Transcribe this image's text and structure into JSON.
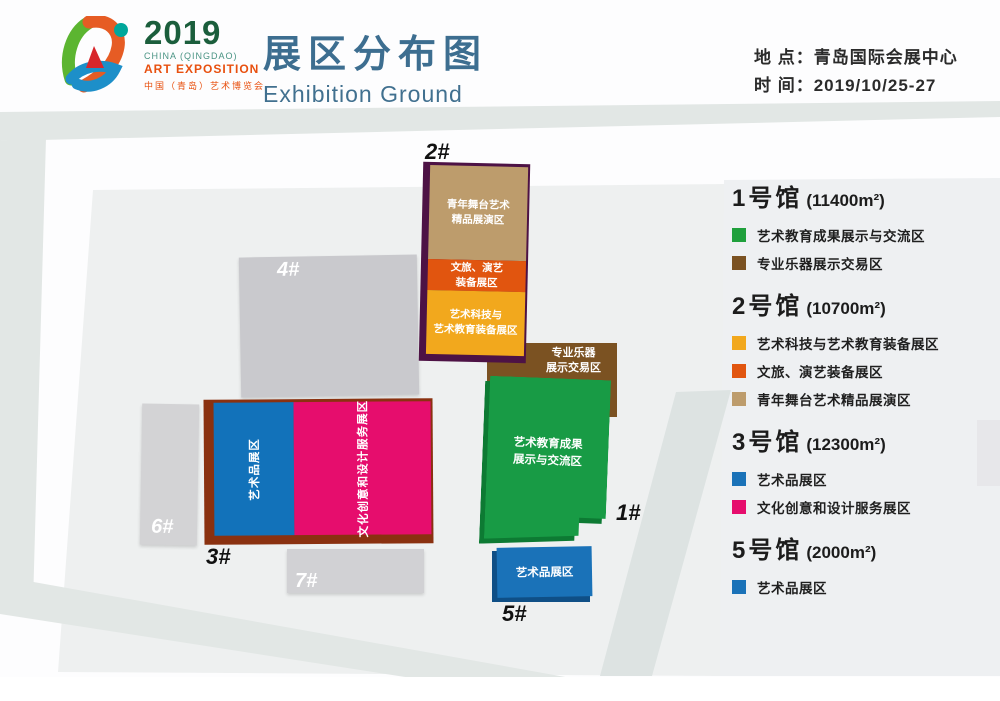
{
  "colors": {
    "tan": "#BD9C6C",
    "orange": "#E1550F",
    "yellow": "#F2A81D",
    "purple_edge": "#4D1245",
    "brown": "#7B5222",
    "green": "#189B45",
    "green_dark": "#0D7A33",
    "blue": "#1A72B8",
    "blue_dark": "#0F4F86",
    "pink": "#E60D6D",
    "maroon_edge": "#8A3110",
    "gray_building": "#C9C9CD",
    "title_blue": "#3D6E90"
  },
  "header": {
    "logo": {
      "year": "2019",
      "sub1": "CHINA (QINGDAO)",
      "sub2": "ART EXPOSITION",
      "sub3": "中国（青岛）艺术博览会"
    },
    "title_cn": "展区分布图",
    "title_en": "Exhibition Ground",
    "info_location": "地 点：青岛国际会展中心",
    "info_time": "时 间：2019/10/25-27"
  },
  "map": {
    "hall2": {
      "label": "2#",
      "sections": [
        {
          "text": "青年舞台艺术\n精品展演区",
          "color": "#BD9C6C"
        },
        {
          "text": "文旅、演艺\n装备展区",
          "color": "#E1550F"
        },
        {
          "text": "艺术科技与\n艺术教育装备展区",
          "color": "#F2A81D"
        }
      ]
    },
    "instruments_block": {
      "text": "专业乐器\n展示交易区",
      "color": "#7B5222"
    },
    "hall1": {
      "label": "1#",
      "text": "艺术教育成果\n展示与交流区",
      "color": "#189B45"
    },
    "hall3": {
      "label": "3#",
      "blue_text": "艺术品展区",
      "pink_text": "文化创意和设计服务展区"
    },
    "hall5": {
      "label": "5#",
      "text": "艺术品展区"
    },
    "hall4": {
      "label": "4#"
    },
    "hall6": {
      "label": "6#"
    },
    "hall7": {
      "label": "7#"
    }
  },
  "legend": {
    "halls": [
      {
        "title": "1号馆",
        "area": "(11400m²)",
        "items": [
          {
            "color": "#1FA03C",
            "label": "艺术教育成果展示与交流区"
          },
          {
            "color": "#7B5222",
            "label": "专业乐器展示交易区"
          }
        ]
      },
      {
        "title": "2号馆",
        "area": "(10700m²)",
        "items": [
          {
            "color": "#F2A81D",
            "label": "艺术科技与艺术教育装备展区"
          },
          {
            "color": "#E1550F",
            "label": "文旅、演艺装备展区"
          },
          {
            "color": "#BD9C6C",
            "label": "青年舞台艺术精品展演区"
          }
        ]
      },
      {
        "title": "3号馆",
        "area": "(12300m²)",
        "items": [
          {
            "color": "#1A72B8",
            "label": "艺术品展区"
          },
          {
            "color": "#E60D6D",
            "label": "文化创意和设计服务展区"
          }
        ]
      },
      {
        "title": "5号馆",
        "area": "(2000m²)",
        "items": [
          {
            "color": "#1A72B8",
            "label": "艺术品展区"
          }
        ]
      }
    ]
  }
}
